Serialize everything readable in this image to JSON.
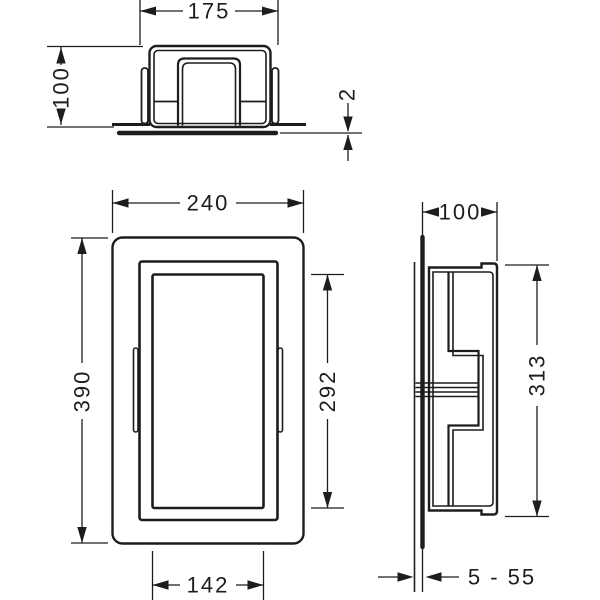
{
  "drawing": {
    "background": "#ffffff",
    "line_color": "#1d1d1b",
    "views": {
      "top": {
        "title": "top-section-view",
        "dims": {
          "cutout_width": "175",
          "depth": "100",
          "frame_lip_thickness": "2"
        }
      },
      "front": {
        "title": "front-view",
        "dims": {
          "outer_width": "240",
          "outer_height": "390",
          "opening_height": "292",
          "opening_width": "142"
        }
      },
      "side": {
        "title": "side-section-view",
        "dims": {
          "depth": "100",
          "body_height": "313",
          "tile_adhesive_range": "5 - 55"
        }
      }
    }
  }
}
